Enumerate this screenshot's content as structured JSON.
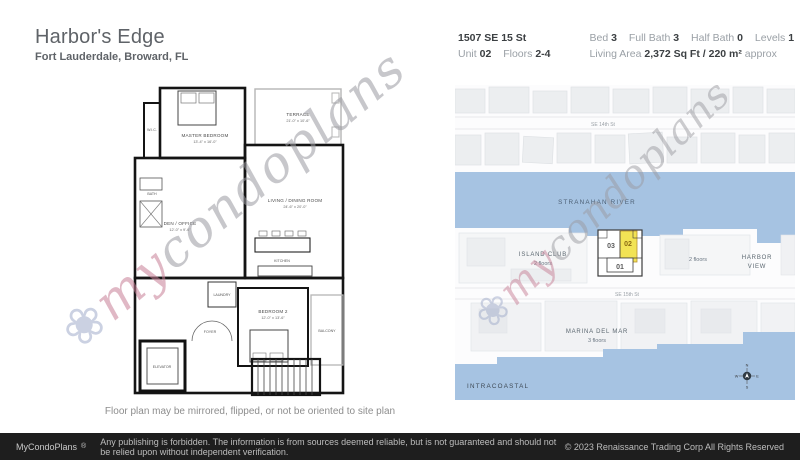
{
  "header": {
    "title": "Harbor's Edge",
    "subtitle": "Fort Lauderdale, Broward, FL",
    "address": "1507 SE 15 St",
    "unit_label": "Unit",
    "unit_value": "02",
    "floors_label": "Floors",
    "floors_value": "2-4",
    "stats": [
      {
        "label": "Bed",
        "value": "3"
      },
      {
        "label": "Full Bath",
        "value": "3"
      },
      {
        "label": "Half Bath",
        "value": "0"
      },
      {
        "label": "Levels",
        "value": "1"
      }
    ],
    "living_area_label": "Living Area",
    "living_area_value": "2,372 Sq Ft",
    "living_area_metric": "/ 220 m²",
    "living_area_approx": "approx"
  },
  "floorplan": {
    "caption": "Floor plan may be mirrored, flipped, or not be oriented to site plan",
    "rooms": [
      {
        "name": "MASTER BEDROOM",
        "dims": "13'-4\" x 16'-0\""
      },
      {
        "name": "TERRACE",
        "dims": "21'-0\" x 10'-6\""
      },
      {
        "name": "LIVING / DINING ROOM",
        "dims": "24'-6\" x 20'-0\""
      },
      {
        "name": "DEN / OFFICE",
        "dims": "12'-0\" x 9'-6\""
      },
      {
        "name": "BEDROOM 2",
        "dims": "12'-0\" x 13'-6\""
      },
      {
        "name": "KITCHEN"
      },
      {
        "name": "BALCONY"
      },
      {
        "name": "ELEVATOR"
      },
      {
        "name": "W.I.C."
      },
      {
        "name": "LAUNDRY"
      },
      {
        "name": "BATH"
      },
      {
        "name": "FOYER"
      }
    ]
  },
  "map": {
    "river_label": "STRANAHAN RIVER",
    "intracoastal_label": "INTRACOASTAL",
    "street_top": "SE 14th St",
    "street_mid": "SE 15th St",
    "island_club_name": "ISLAND CLUB",
    "island_club_floors": "2 floors",
    "neighbor_floors": "2 floors",
    "harbor_view_line1": "HARBOR",
    "harbor_view_line2": "VIEW",
    "marina_name": "MARINA DEL MAR",
    "marina_floors": "3 floors",
    "units": [
      "03",
      "02",
      "01"
    ],
    "compass": {
      "n": "N",
      "e": "E",
      "s": "S",
      "w": "W"
    },
    "water_color": "#a6c3e2",
    "highlight_color": "#f2e355"
  },
  "watermark": {
    "flower": "❀",
    "prefix": "my",
    "suffix": "condoplans"
  },
  "footer": {
    "brand": "MyCondoPlans",
    "reg": "®",
    "disclaimer": "Any publishing is forbidden. The information is from sources deemed reliable, but is not guaranteed and should not be relied upon without independent verification.",
    "copyright": "© 2023 Renaissance Trading Corp  All Rights Reserved"
  }
}
